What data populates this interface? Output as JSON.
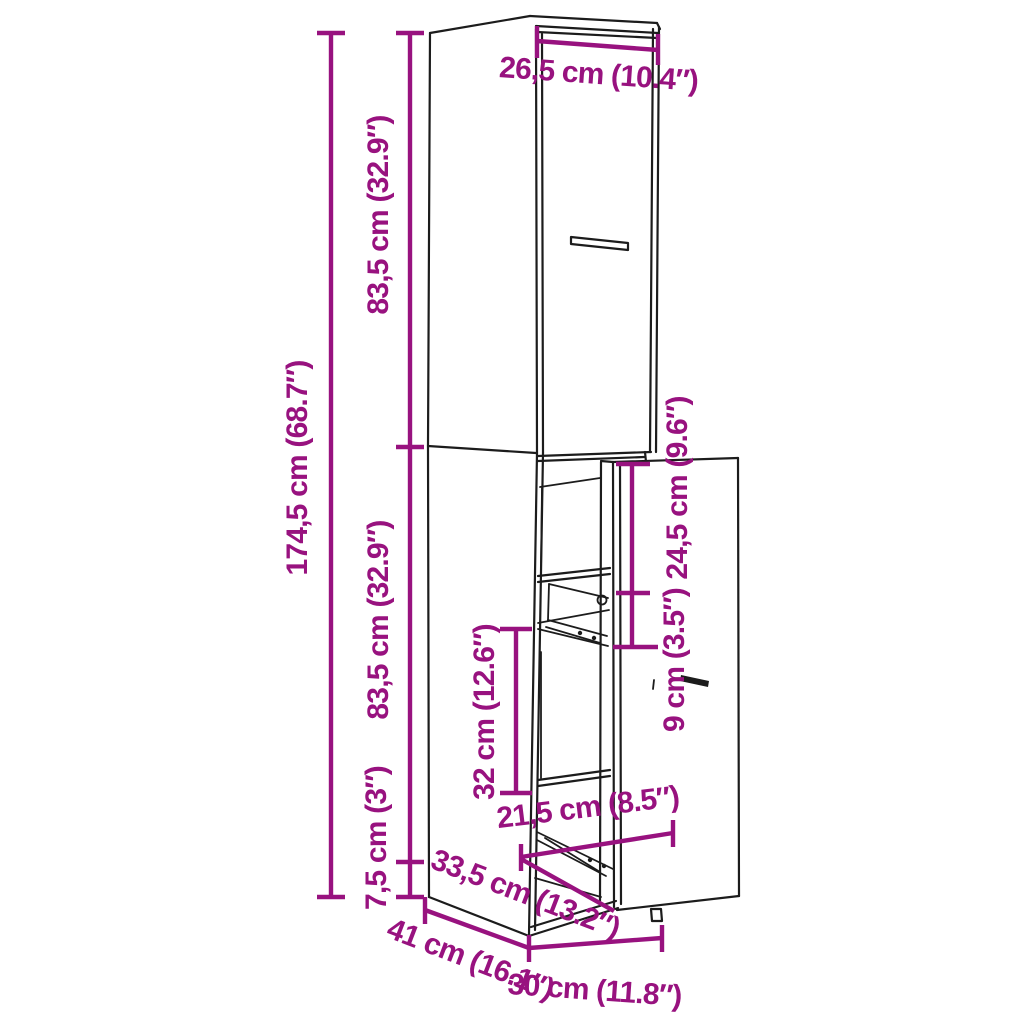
{
  "diagram": {
    "kind": "furniture-dimension-line-drawing",
    "product": "tall narrow apothecary pull-out cabinet",
    "background": "#ffffff",
    "line_color": "#1c1c1c",
    "dimension_color": "#98127f"
  },
  "dim": {
    "top_width": "26,5 cm (10.4″)",
    "upper_height": "83,5 cm (32.9″)",
    "total_height": "174,5 cm (68.7″)",
    "lower_height": "83,5 cm (32.9″)",
    "plinth_height": "7,5 cm (3″)",
    "top_clearance": "24,5 cm (9.6″)",
    "handle_clearance": "9 cm (3.5″)",
    "shelf_spacing": "32 cm (12.6″)",
    "drawer_width": "21,5 cm (8.5″)",
    "drawer_depth": "33,5 cm (13.2″)",
    "cabinet_depth": "41 cm (16.1″)",
    "cabinet_width": "30 cm (11.8″)"
  }
}
